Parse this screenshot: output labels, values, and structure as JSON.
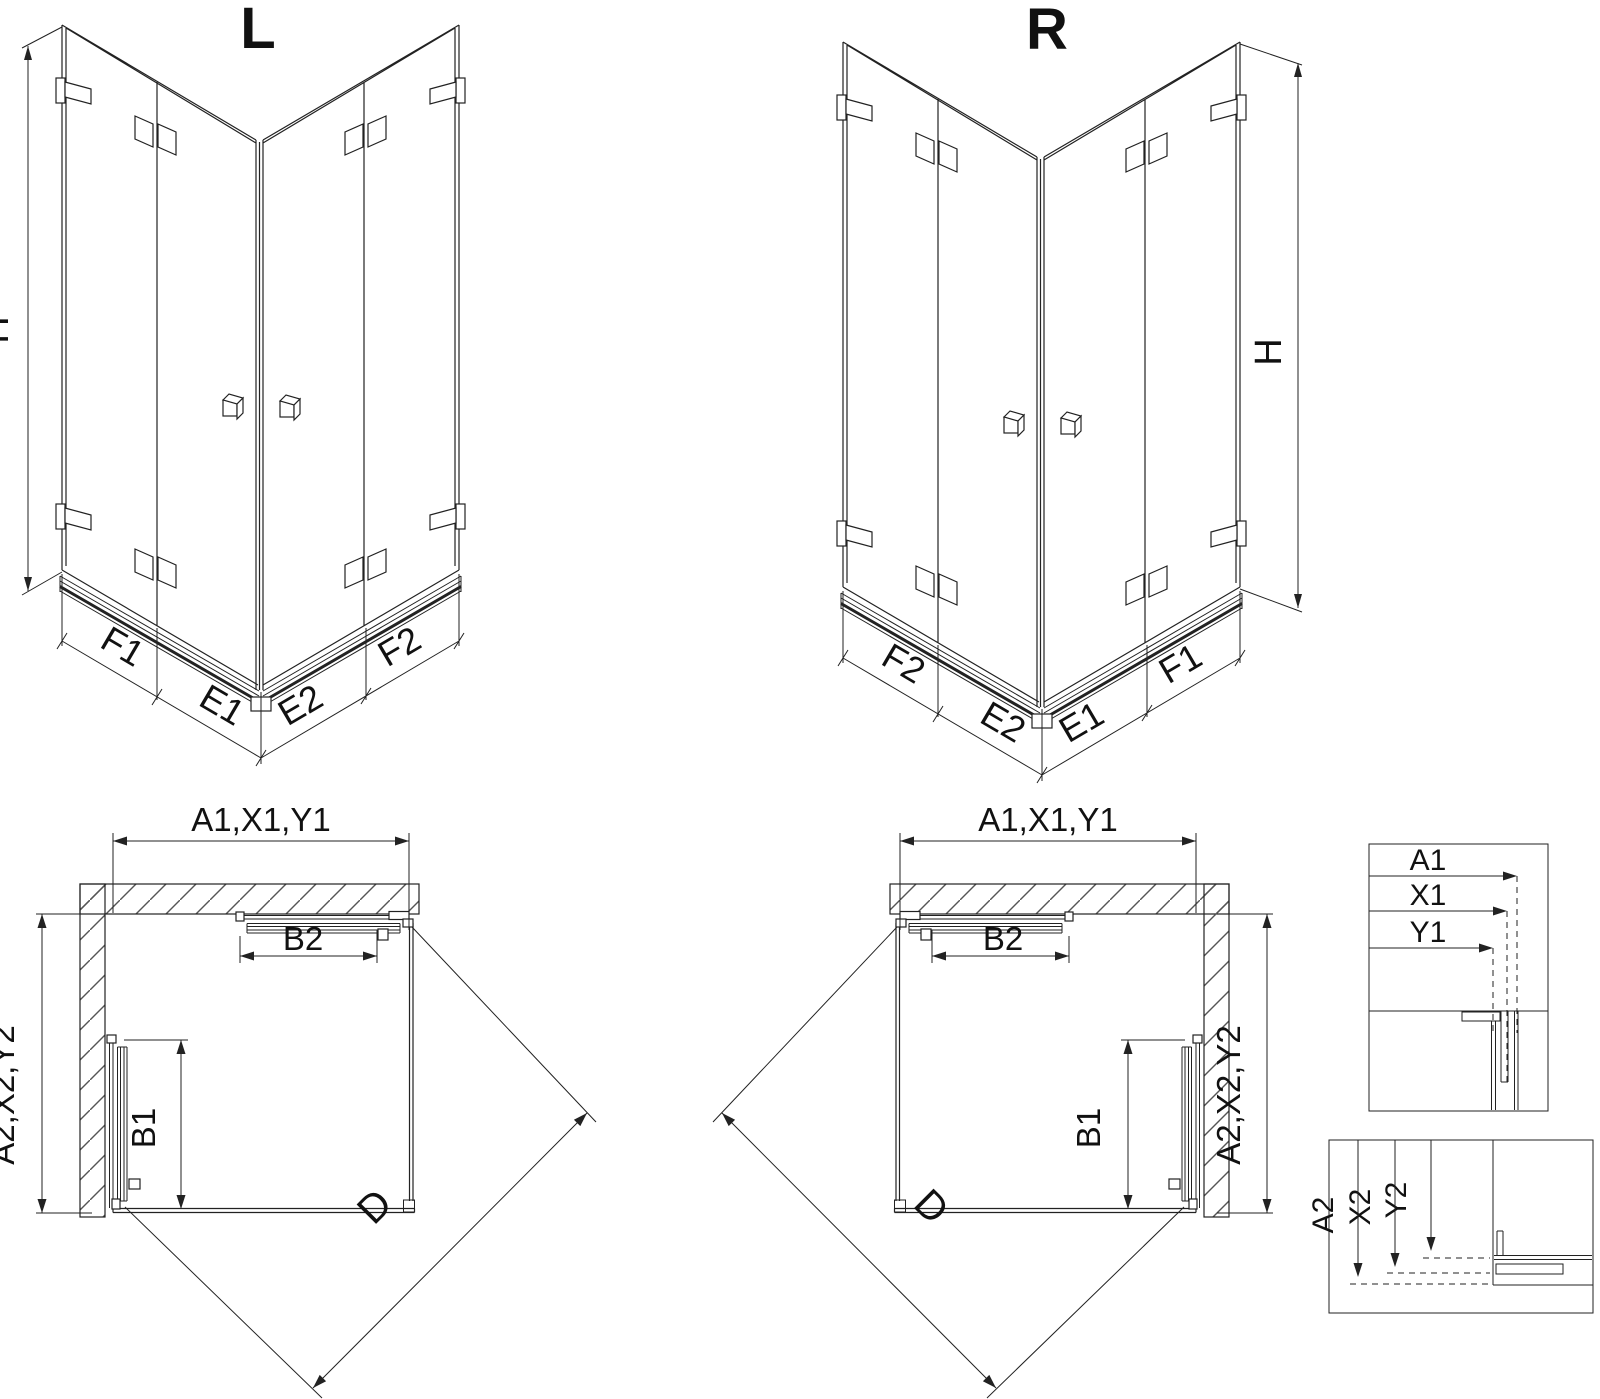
{
  "drawing": {
    "background_color": "#ffffff",
    "line_color": "#222222",
    "text_color": "#111111"
  },
  "iso_left": {
    "title": "L",
    "h_label": "H",
    "seg_labels": [
      "F1",
      "E1",
      "E2",
      "F2"
    ]
  },
  "iso_right": {
    "title": "R",
    "h_label": "H",
    "seg_labels": [
      "F2",
      "E2",
      "E1",
      "F1"
    ]
  },
  "plan_left": {
    "width_label": "A1,X1,Y1",
    "depth_label": "A2,X2,Y2",
    "door_top_label": "B2",
    "door_side_label": "B1",
    "diagonal_label": "D"
  },
  "plan_right": {
    "width_label": "A1,X1,Y1",
    "depth_label": "A2,X2,Y2",
    "door_top_label": "B2",
    "door_side_label": "B1",
    "diagonal_label": "D"
  },
  "detail_width": {
    "labels": [
      "A1",
      "X1",
      "Y1"
    ]
  },
  "detail_depth": {
    "labels": [
      "A2",
      "X2",
      "Y2"
    ]
  }
}
